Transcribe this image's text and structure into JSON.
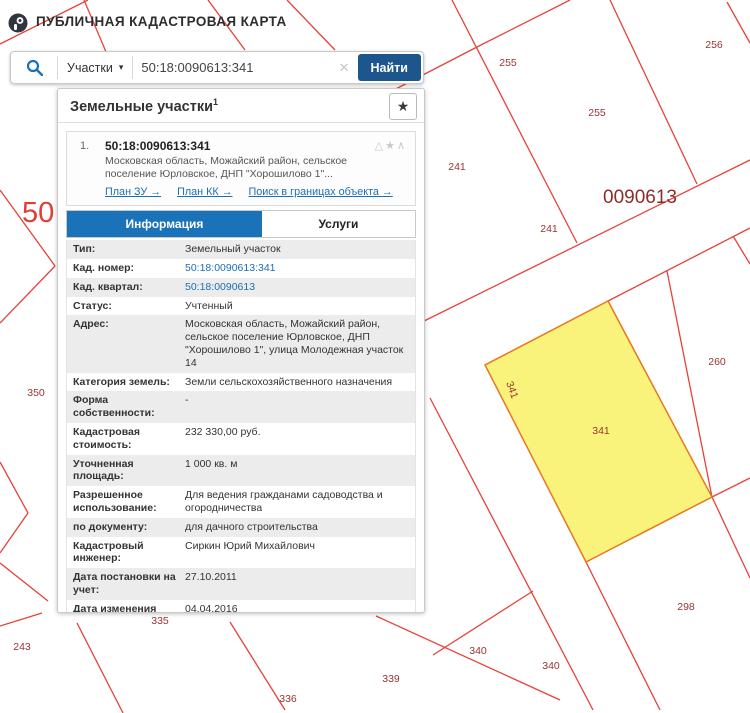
{
  "header": {
    "title": "ПУБЛИЧНАЯ КАДАСТРОВАЯ КАРТА"
  },
  "search": {
    "category_label": "Участки",
    "caret": "▾",
    "query": "50:18:0090613:341",
    "clear": "✕",
    "find_label": "Найти"
  },
  "panel": {
    "title": "Земельные участки",
    "title_sup": "1",
    "fav_star": "★",
    "result": {
      "index": "1.",
      "cad_number": "50:18:0090613:341",
      "icons": "△★∧",
      "address_short": "Московская область, Можайский район, сельское поселение Юрловское, ДНП \"Хорошилово 1\"...",
      "links": [
        {
          "label": "План ЗУ →"
        },
        {
          "label": "План КК →"
        },
        {
          "label": "Поиск в границах объекта →"
        }
      ]
    },
    "tabs": [
      {
        "label": "Информация",
        "active": true
      },
      {
        "label": "Услуги",
        "active": false
      }
    ],
    "info_rows": [
      {
        "label": "Тип:",
        "value": "Земельный участок"
      },
      {
        "label": "Кад. номер:",
        "value": "50:18:0090613:341"
      },
      {
        "label": "Кад. квартал:",
        "value": "50:18:0090613"
      },
      {
        "label": "Статус:",
        "value": "Учтенный"
      },
      {
        "label": "Адрес:",
        "value": "Московская область, Можайский район, сельское поселение Юрловское, ДНП \"Хорошилово 1\", улица Молодежная участок 14"
      },
      {
        "label": "Категория земель:",
        "value": "Земли сельскохозяйственного назначения"
      },
      {
        "label": "Форма собственности:",
        "value": "-"
      },
      {
        "label": "Кадастровая стоимость:",
        "value": "232 330,00 руб."
      },
      {
        "label": "Уточненная площадь:",
        "value": "1 000 кв. м"
      },
      {
        "label": "Разрешенное использование:",
        "value": "Для ведения гражданами садоводства и огородничества"
      },
      {
        "label": "по документу:",
        "value": "для дачного строительства"
      },
      {
        "label": "Кадастровый инженер:",
        "value": "Сиркин Юрий Михайлович"
      },
      {
        "label": "Дата постановки на учет:",
        "value": "27.10.2011"
      },
      {
        "label": "Дата изменения сведений в ГКН:",
        "value": "04.04.2016"
      },
      {
        "label": "Дата выгрузки сведений из ГКН:",
        "value": "04.04.2016"
      }
    ]
  },
  "map": {
    "line_color": "#e6423a",
    "selected_parcel": {
      "id": "341",
      "fill": "#f9f37c",
      "stroke": "#e8771f",
      "points": "608,301 712,497 586,562 485,365"
    },
    "labels": [
      {
        "text": "255",
        "x": 508,
        "y": 66
      },
      {
        "text": "256",
        "x": 714,
        "y": 48
      },
      {
        "text": "255",
        "x": 597,
        "y": 116
      },
      {
        "text": "241",
        "x": 457,
        "y": 170
      },
      {
        "text": "241",
        "x": 549,
        "y": 232
      },
      {
        "text": "260",
        "x": 717,
        "y": 365
      },
      {
        "text": "341",
        "x": 601,
        "y": 434
      },
      {
        "text": "341",
        "x": 509,
        "y": 391,
        "rotated": true
      },
      {
        "text": "298",
        "x": 686,
        "y": 610
      },
      {
        "text": "340",
        "x": 478,
        "y": 654
      },
      {
        "text": "340",
        "x": 551,
        "y": 669
      },
      {
        "text": "339",
        "x": 391,
        "y": 682
      },
      {
        "text": "336",
        "x": 288,
        "y": 702
      },
      {
        "text": "243",
        "x": 22,
        "y": 650
      },
      {
        "text": "335",
        "x": 160,
        "y": 624
      },
      {
        "text": "350",
        "x": 36,
        "y": 396
      }
    ],
    "quarter_label": {
      "text": "0090613",
      "x": 640,
      "y": 203
    },
    "big_label": {
      "text": "50",
      "x": 22,
      "y": 222
    }
  }
}
